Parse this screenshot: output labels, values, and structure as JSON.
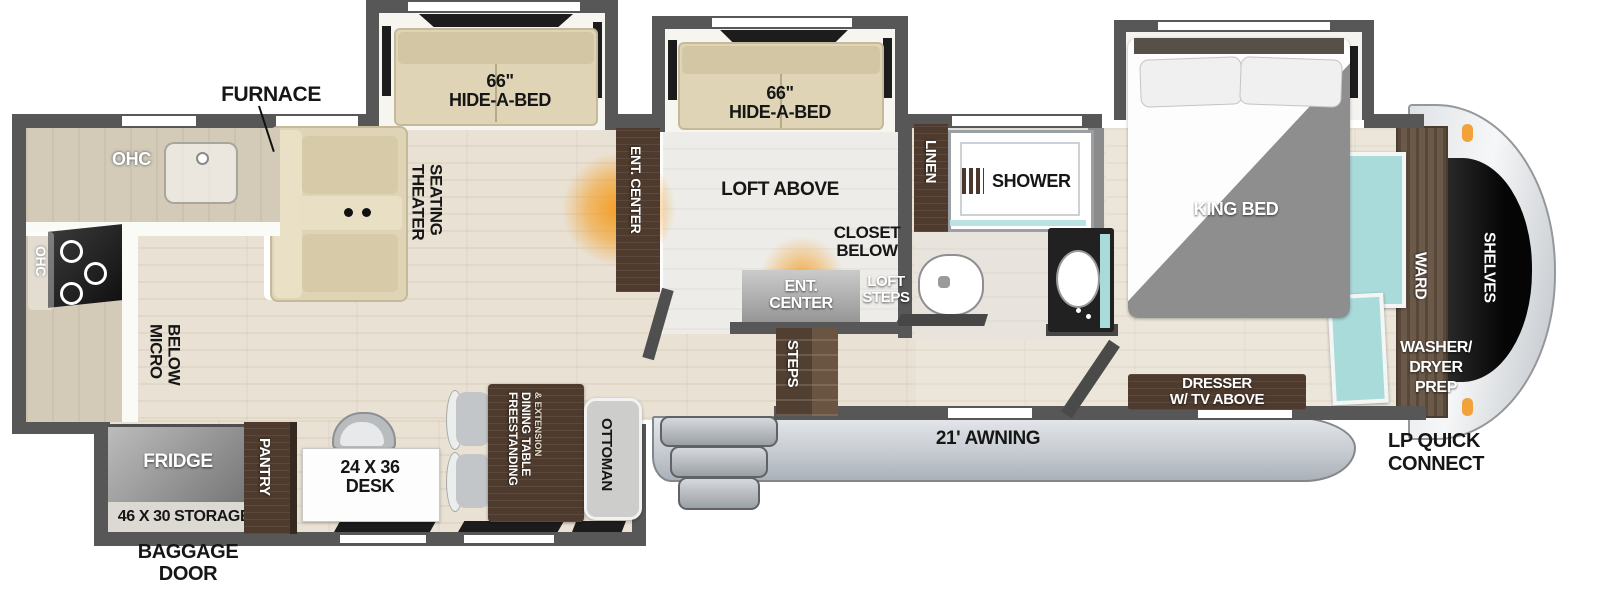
{
  "plan": {
    "type": "rv-fifth-wheel-floorplan",
    "labels": {
      "furnace": "FURNACE",
      "ohc_rear": "OHC",
      "ohc_side": "OHC",
      "micro": [
        "MICRO",
        "BELOW"
      ],
      "theater": [
        "THEATER",
        "SEATING"
      ],
      "slide1": [
        "66\"",
        "HIDE-A-BED"
      ],
      "slide2": [
        "66\"",
        "HIDE-A-BED"
      ],
      "ent_center_wall": "ENT. CENTER",
      "loft_above": "LOFT ABOVE",
      "closet_below": [
        "CLOSET",
        "BELOW"
      ],
      "ent_center_cabinet": [
        "ENT.",
        "CENTER"
      ],
      "loft_steps": [
        "LOFT",
        "STEPS"
      ],
      "steps": "STEPS",
      "linen": "LINEN",
      "shower": "SHOWER",
      "king_bed": "KING BED",
      "dresser": [
        "DRESSER",
        "W/ TV ABOVE"
      ],
      "ward": "WARD",
      "shelves": "SHELVES",
      "washer_dryer": [
        "WASHER/",
        "DRYER",
        "PREP"
      ],
      "lp_connect": [
        "LP QUICK",
        "CONNECT"
      ],
      "awning": "21' AWNING",
      "fridge": "FRIDGE",
      "pantry": "PANTRY",
      "storage": "46 X 30 STORAGE",
      "baggage": [
        "BAGGAGE",
        "DOOR"
      ],
      "desk": [
        "24 X 36",
        "DESK"
      ],
      "dining": [
        "FREESTANDING",
        "DINING TABLE",
        "& EXTENSION"
      ],
      "ottoman": "OTTOMAN"
    },
    "colors": {
      "wall": "#575757",
      "floor_wood": "#e9e1d3",
      "furniture_cream": "#dfd5b6",
      "cabinet_brown": "#4e3b2d",
      "fireplace_orange": "#f49a1a",
      "teal_glass": "#a9dbda",
      "fridge_gray": "#8f8f8f",
      "awning_gray": "#c6cbd1",
      "marker_light_orange": "#f1a23b"
    }
  }
}
